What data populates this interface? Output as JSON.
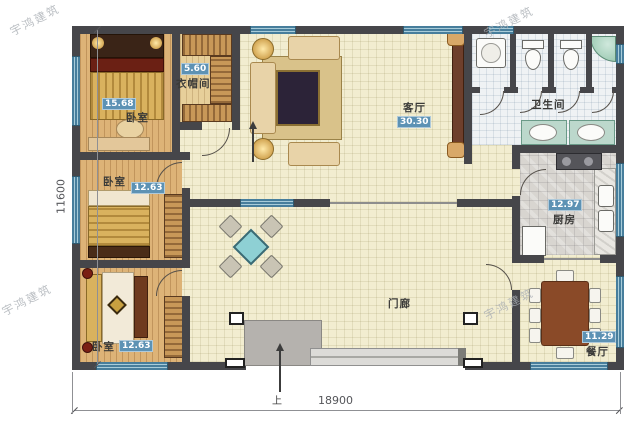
{
  "watermark": {
    "text": "宇鸿建筑"
  },
  "dimensions": {
    "bottom": "18900",
    "left": "11600"
  },
  "rooms": {
    "bedroom1": {
      "label": "卧室",
      "area": "15.68"
    },
    "cloakroom": {
      "label": "衣帽间",
      "area": "5.60"
    },
    "living": {
      "label": "客厅",
      "area": "30.30"
    },
    "bathroom": {
      "label": "卫生间",
      "area": ""
    },
    "kitchen": {
      "label": "厨房",
      "area": "12.97"
    },
    "bedroom2": {
      "label": "卧室",
      "area": "12.63"
    },
    "bedroom3": {
      "label": "卧室",
      "area": "12.63"
    },
    "hall": {
      "label": "门廊",
      "area": ""
    },
    "dining": {
      "label": "餐厅",
      "area": "11.29"
    }
  },
  "entrance": {
    "up_label": "上"
  },
  "fixtures": [
    "bed",
    "wardrobe",
    "sofa-set",
    "tv-cabinet",
    "washing-machine",
    "toilet",
    "shower",
    "basin",
    "stove",
    "sink",
    "fridge",
    "square-table",
    "dining-table",
    "entry-steps"
  ],
  "colors": {
    "wall": "#46464a",
    "window": "#477e9c",
    "area_badge": "#5d92b4",
    "floor_wood": "#ddb377",
    "floor_tile": "#f2edd0",
    "floor_bath": "#eff2f4",
    "floor_kitchen": "#d8d5d0",
    "steps_gray": "#b5b2ae"
  }
}
